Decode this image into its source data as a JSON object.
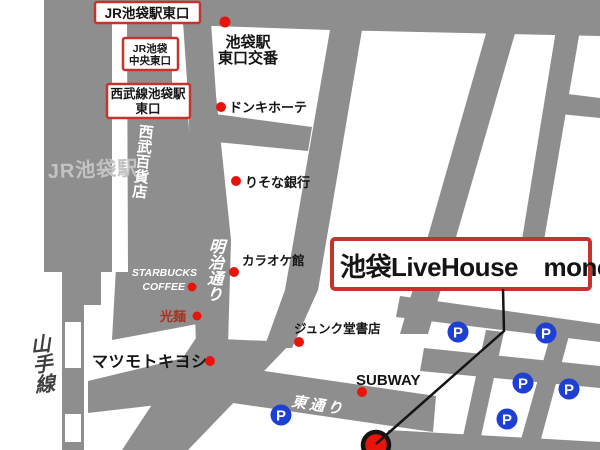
{
  "colors": {
    "gray": "#8e8e8e",
    "red_box": "#c5342c",
    "red_dot": "#e8140c",
    "dark_red": "#a93123",
    "blue": "#1e3fd4",
    "ink": "#141414",
    "building_text": "#c3c3c3",
    "rail_text": "#3f3f3f"
  },
  "venue": {
    "name": "池袋LiveHouse　mono"
  },
  "exits": {
    "jr_east": "JR池袋駅東口",
    "jr_central_l1": "JR池袋",
    "jr_central_l2": "中央東口",
    "seibu_l1": "西武線池袋駅",
    "seibu_l2": "東口"
  },
  "places": {
    "koban_l1": "池袋駅",
    "koban_l2": "東口交番",
    "donki": "ドンキホーテ",
    "risona": "りそな銀行",
    "karaoke": "カラオケ館",
    "starbucks_l1": "STARBUCKS",
    "starbucks_l2": "COFFEE",
    "komen": "光麺",
    "matsumoto": "マツモトキヨシ",
    "junkudo": "ジュンク堂書店",
    "subway": "SUBWAY"
  },
  "buildings": {
    "jr_station": "JR池袋駅",
    "seibu_store": "西武百貨店"
  },
  "roads": {
    "meiji": "明治通り",
    "higashi": "東通り",
    "yamanote": "山手線"
  },
  "parking": {
    "glyph": "P",
    "count": 6
  }
}
